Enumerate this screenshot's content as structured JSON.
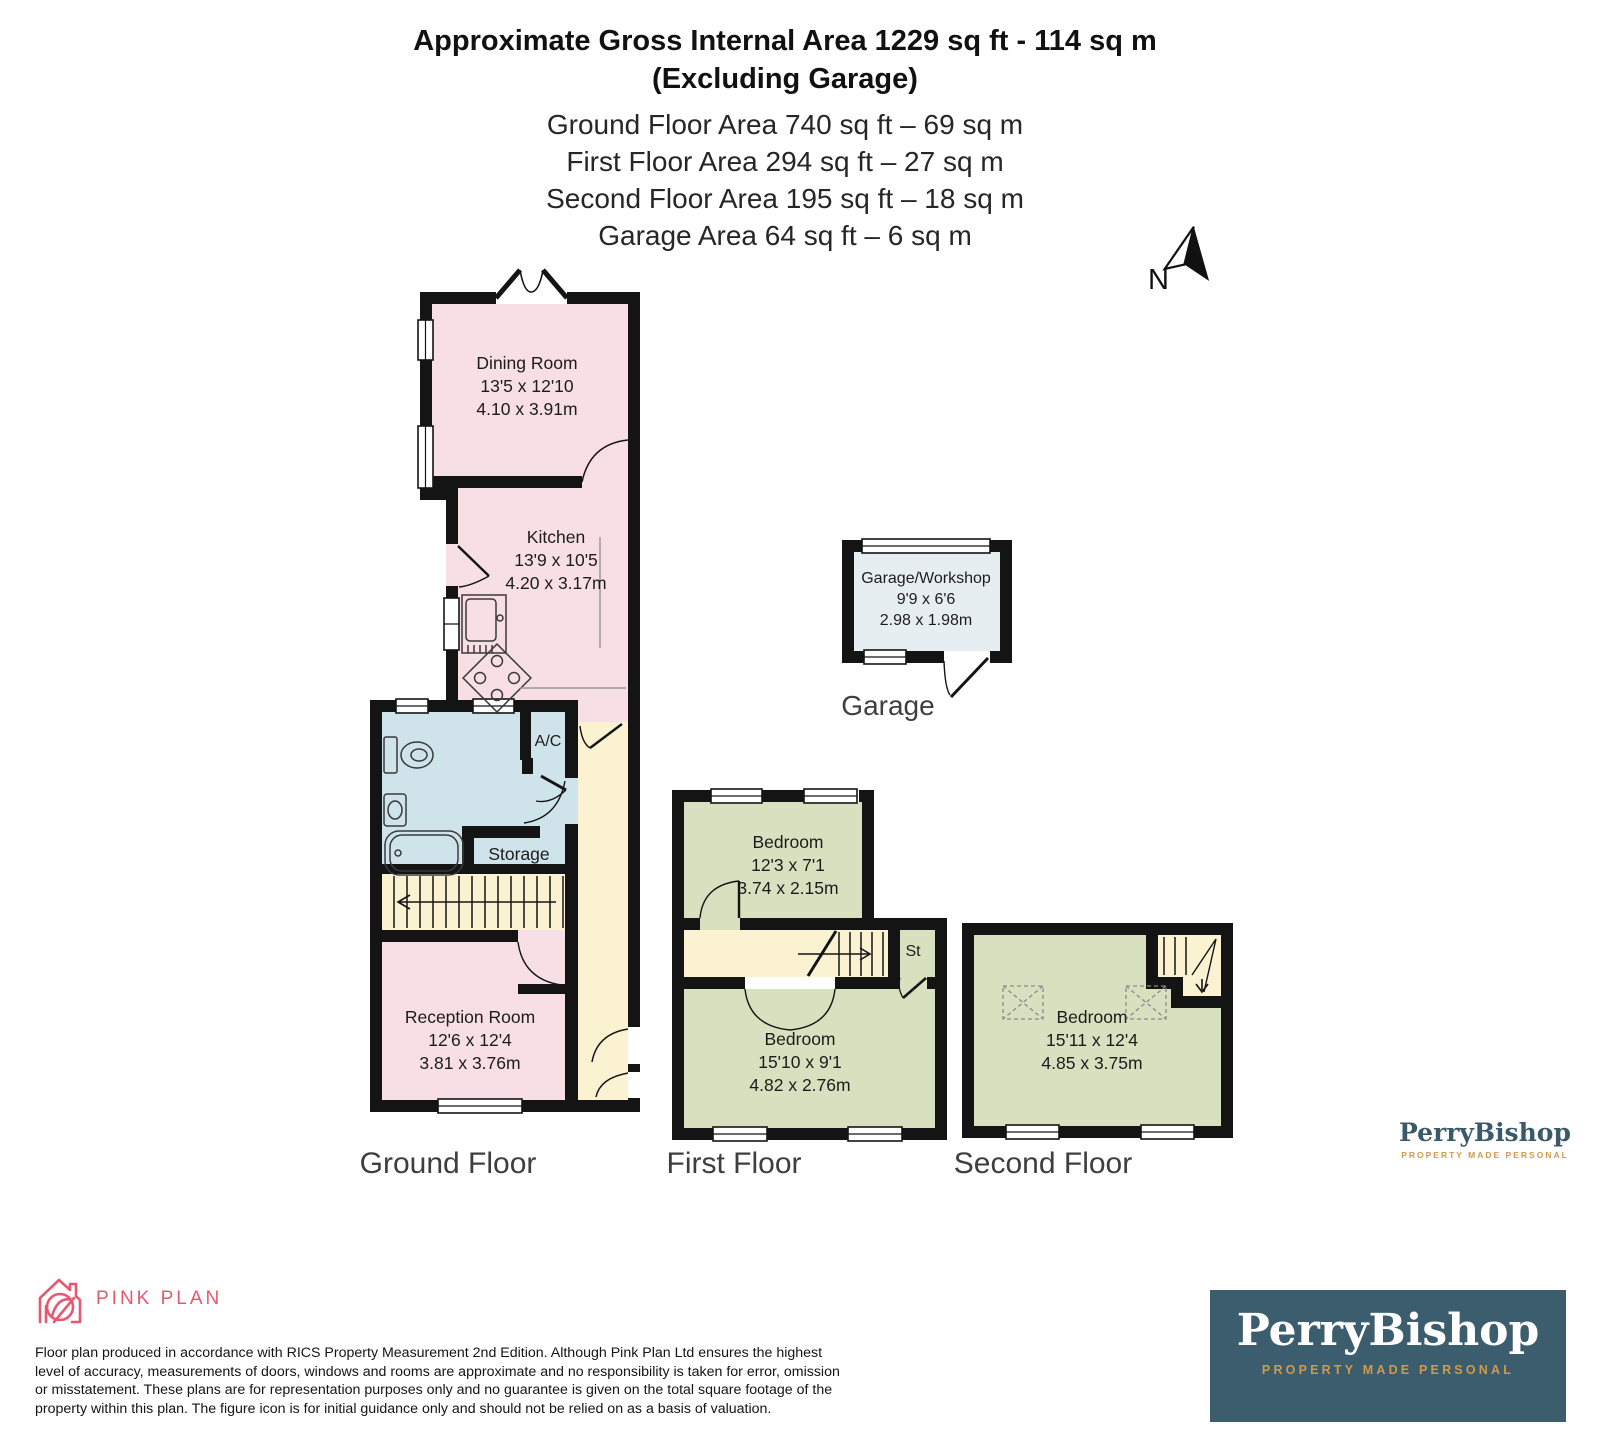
{
  "header": {
    "title_line1": "Approximate Gross Internal Area 1229 sq ft - 114 sq m",
    "title_line2": "(Excluding Garage)",
    "area_lines": [
      "Ground Floor Area 740 sq ft – 69 sq m",
      "First Floor Area 294 sq ft – 27 sq m",
      "Second Floor Area 195 sq ft – 18 sq m",
      "Garage Area 64 sq ft – 6 sq m"
    ],
    "north_label": "N"
  },
  "rooms": {
    "dining": {
      "name": "Dining Room",
      "imperial": "13'5 x 12'10",
      "metric": "4.10 x 3.91m"
    },
    "kitchen": {
      "name": "Kitchen",
      "imperial": "13'9 x 10'5",
      "metric": "4.20 x 3.17m"
    },
    "ac": {
      "name": "A/C"
    },
    "storage": {
      "name": "Storage"
    },
    "reception": {
      "name": "Reception Room",
      "imperial": "12'6 x 12'4",
      "metric": "3.81 x 3.76m"
    },
    "garage": {
      "name": "Garage/Workshop",
      "imperial": "9'9 x 6'6",
      "metric": "2.98 x 1.98m"
    },
    "bedroom1": {
      "name": "Bedroom",
      "imperial": "12'3 x 7'1",
      "metric": "3.74 x 2.15m"
    },
    "st": {
      "name": "St"
    },
    "bedroom2": {
      "name": "Bedroom",
      "imperial": "15'10 x 9'1",
      "metric": "4.82 x 2.76m"
    },
    "bedroom3": {
      "name": "Bedroom",
      "imperial": "15'11 x 12'4",
      "metric": "4.85 x 3.75m"
    }
  },
  "floor_labels": {
    "ground": "Ground Floor",
    "first": "First Floor",
    "second": "Second Floor",
    "garage": "Garage"
  },
  "branding": {
    "pinkplan": {
      "wordmark": "PINK PLAN"
    },
    "perrybishop": {
      "wordmark": "PerryBishop",
      "tagline": "PROPERTY MADE PERSONAL"
    }
  },
  "disclaimer_lines": [
    "Floor plan produced in accordance with RICS Property Measurement 2nd Edition. Although Pink Plan Ltd ensures the highest",
    "level of accuracy, measurements of doors, windows and rooms are approximate and no responsibility is taken for error, omission",
    "or misstatement. These plans are for representation purposes only and no guarantee is given on the total square footage of the",
    "property within this plan. The figure icon is for initial guidance only and should not be relied on as a basis of valuation."
  ],
  "colors": {
    "wall": "#141414",
    "room_pink": "#f7dfe5",
    "room_green": "#d9e0bf",
    "room_blue": "#cfe3eb",
    "hall_cream": "#fbf2d2",
    "garage_blue": "#e7eef2",
    "brand_navy": "#3c5d6e",
    "brand_gold": "#d09a4a",
    "brand_pink": "#e8586f"
  }
}
